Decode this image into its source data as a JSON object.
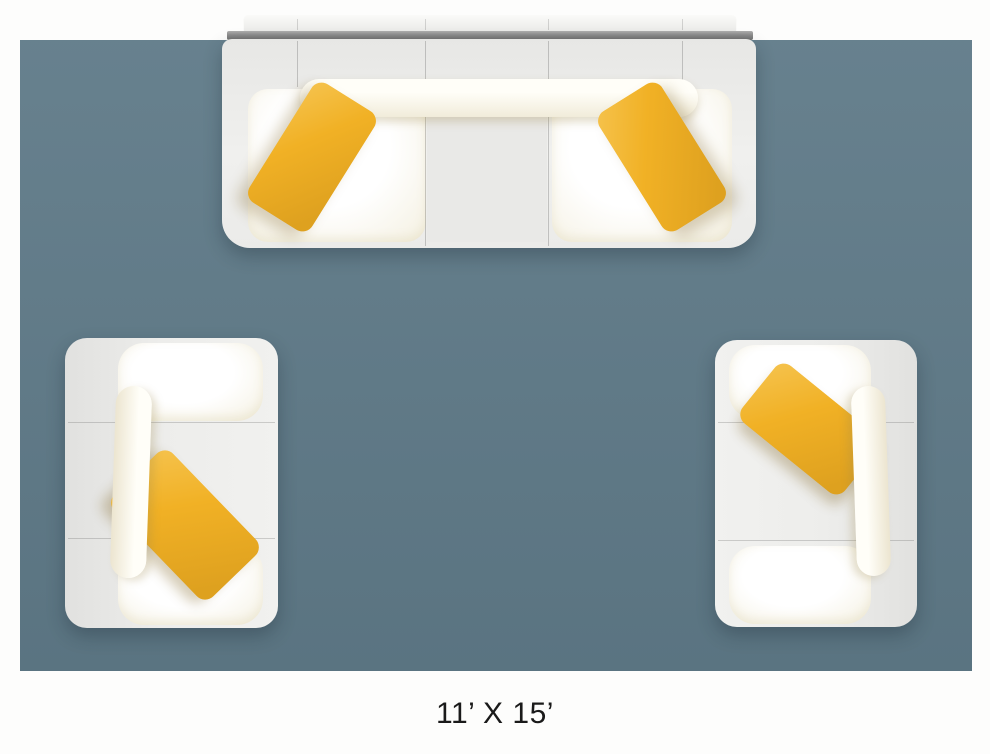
{
  "figure": {
    "caption": "11’ X 15’",
    "background_color": "#fdfdfc"
  },
  "rug": {
    "color": "#5f7a88"
  },
  "furniture": {
    "pillow_color": "#f1b125",
    "upholstery_color": "#ededeb",
    "cushion_color": "#fdfcf6",
    "back_edge_color": "#8b8b8b"
  }
}
